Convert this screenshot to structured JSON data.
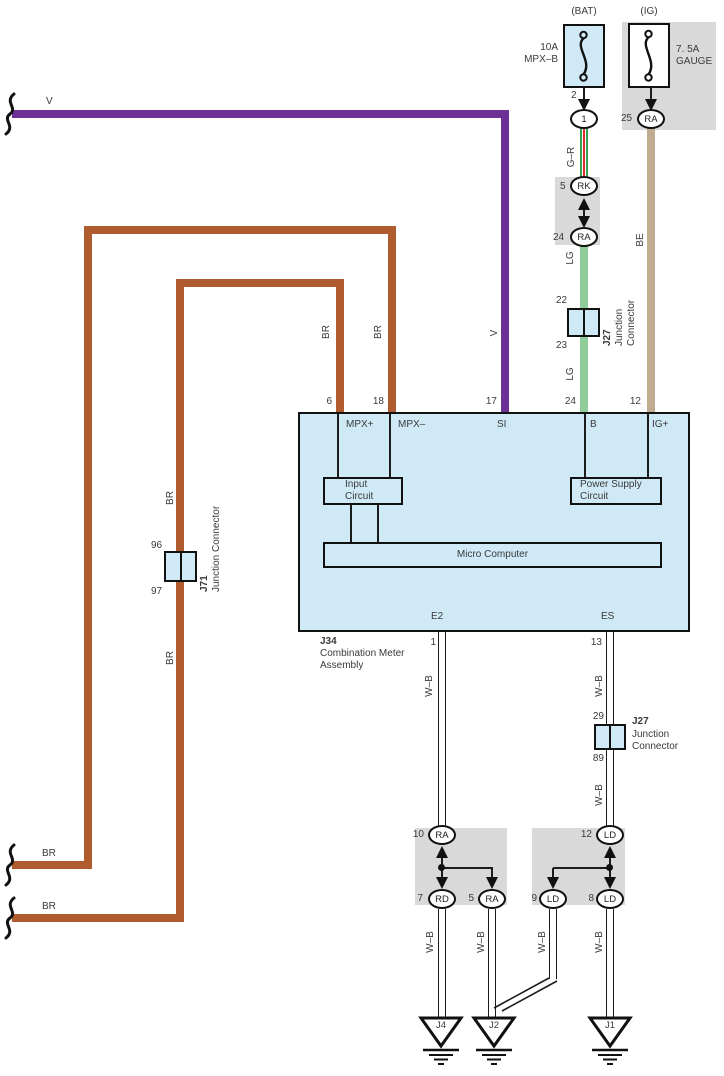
{
  "top": {
    "bat": {
      "header": "(BAT)",
      "rating": "10A",
      "name": "MPX–B",
      "pin": "2",
      "connector": "1"
    },
    "ig": {
      "header": "(IG)",
      "rating": "7. 5A",
      "name": "GAUGE",
      "pin": "25",
      "connector": "RA"
    },
    "rk_pin": "5",
    "rk": "RK",
    "ra_pin": "24",
    "ra": "RA",
    "j27": {
      "pin_top": "22",
      "pin_bottom": "23",
      "id": "J27",
      "name_l1": "Junction",
      "name_l2": "Connector"
    },
    "pin_b": "24",
    "pin_ig": "12"
  },
  "wire_labels": {
    "v_top": "V",
    "v_side": "V",
    "gr": "G–R",
    "lg_upper": "LG",
    "lg_lower": "LG",
    "be": "BE",
    "br_mpx_plus": "BR",
    "br_mpx_minus": "BR",
    "br_j71_above": "BR",
    "br_j71_below": "BR",
    "br_exit_upper": "BR",
    "br_exit_lower": "BR",
    "wb_e2": "W–B",
    "wb_es_upper": "W–B",
    "wb_es_lower": "W–B",
    "wb_j4": "W–B",
    "wb_j2": "W–B",
    "wb_ld9": "W–B",
    "wb_j1": "W–B"
  },
  "main_unit": {
    "pin_mpx_plus_no": "6",
    "pin_mpx_plus": "MPX+",
    "pin_mpx_minus_no": "18",
    "pin_mpx_minus": "MPX–",
    "pin_si_no": "17",
    "pin_si": "SI",
    "pin_b": "B",
    "pin_ig": "IG+",
    "input_l1": "Input",
    "input_l2": "Circuit",
    "power_l1": "Power Supply",
    "power_l2": "Circuit",
    "micro": "Micro Computer",
    "pin_e2": "E2",
    "pin_e2_no": "1",
    "pin_es": "ES",
    "pin_es_no": "13",
    "id": "J34",
    "name_l1": "Combination Meter",
    "name_l2": "Assembly"
  },
  "j71": {
    "pin_top": "96",
    "pin_bottom": "97",
    "id": "J71",
    "name": "Junction Connector"
  },
  "j27_mid": {
    "pin_top": "29",
    "pin_bottom": "89",
    "id": "J27",
    "name_l1": "Junction",
    "name_l2": "Connector"
  },
  "relay_left": {
    "top_pin": "10",
    "top": "RA",
    "bottom_left_pin": "7",
    "bottom_left": "RD",
    "bottom_right_pin": "5",
    "bottom_right": "RA"
  },
  "relay_right": {
    "top_pin": "12",
    "top": "LD",
    "bottom_left_pin": "9",
    "bottom_left": "LD",
    "bottom_right_pin": "8",
    "bottom_right": "LD"
  },
  "grounds": {
    "j4": "J4",
    "j2": "J2",
    "j1": "J1"
  },
  "colors": {
    "violet": "#6c3096",
    "brown": "#b15c2f",
    "light_green": "#8fcc99",
    "beige": "#c2ac90",
    "green": "#33a34f",
    "red": "#d92b2b",
    "panel_blue": "#cfe9f6",
    "gray": "#d9d9d9"
  }
}
